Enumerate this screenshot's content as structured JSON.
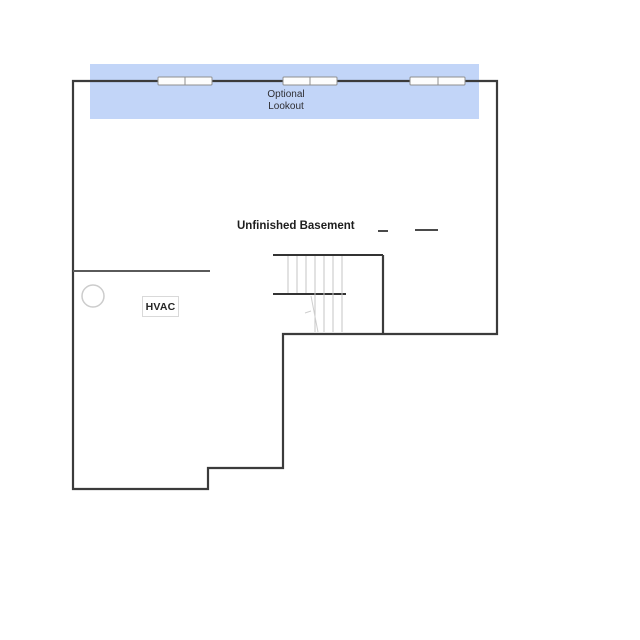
{
  "page": {
    "background_color": "#ffffff",
    "type": "floor-plan-drawing"
  },
  "plan": {
    "room_label": "Unfinished Basement",
    "lookout": {
      "line1": "Optional",
      "line2": "Lookout",
      "band_color": "#c2d5f8"
    },
    "hvac": {
      "label": "HVAC"
    },
    "symbols": {
      "windows": [
        "window-symbol-left",
        "window-symbol-center",
        "window-symbol-right"
      ],
      "window_count": 3,
      "sump_pit": "circle-symbol",
      "stairs": "stair-treads-with-landing",
      "dash_marks": [
        "short-dash",
        "long-dash"
      ]
    },
    "colors": {
      "wall": "#3b3b3b",
      "interior_wall": "#5a5a5a",
      "stair_line": "#333333",
      "tread": "#c5c5c5",
      "window_border": "#8f8f8f",
      "text": "#2e2e33",
      "hvac_border": "#d9d9d9"
    }
  }
}
